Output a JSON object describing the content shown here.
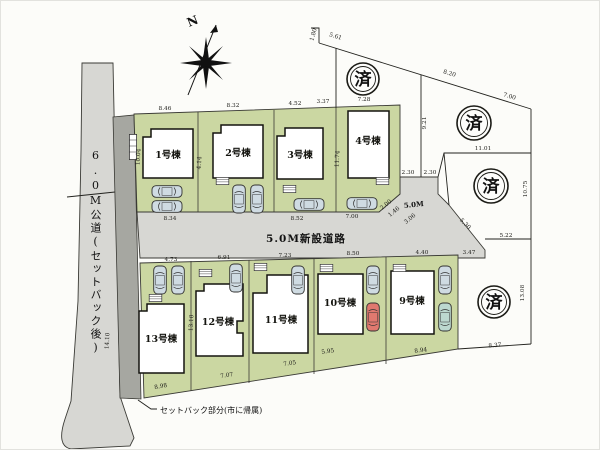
{
  "title": "site-plan",
  "north_label": "N",
  "sold_label": "済",
  "roads": {
    "public_road_label": "6.0M公道(セットバック後)",
    "new_road_label": "5.0M新設道路",
    "new_road_width": "5.0M",
    "setback_note": "セットバック部分(市に帰属)"
  },
  "buildings": [
    "1号棟",
    "2号棟",
    "3号棟",
    "4号棟",
    "9号棟",
    "10号棟",
    "11号棟",
    "12号棟",
    "13号棟"
  ],
  "dims": [
    "8.46",
    "8.32",
    "4.52",
    "3.37",
    "7.28",
    "1.80",
    "5.61",
    "8.20",
    "7.00",
    "9.21",
    "11.01",
    "10.75",
    "2.30",
    "2.30",
    "5.30",
    "5.22",
    "3.47",
    "8.37",
    "13.08",
    "14.10",
    "4.73",
    "6.91",
    "7.23",
    "8.50",
    "8.94",
    "5.95",
    "7.05",
    "7.07",
    "8.98",
    "2.00",
    "1.46",
    "3.06",
    "10.04",
    "4.14",
    "11.74",
    "13.10",
    "8.34",
    "8.52",
    "7.00",
    "4.40"
  ]
}
